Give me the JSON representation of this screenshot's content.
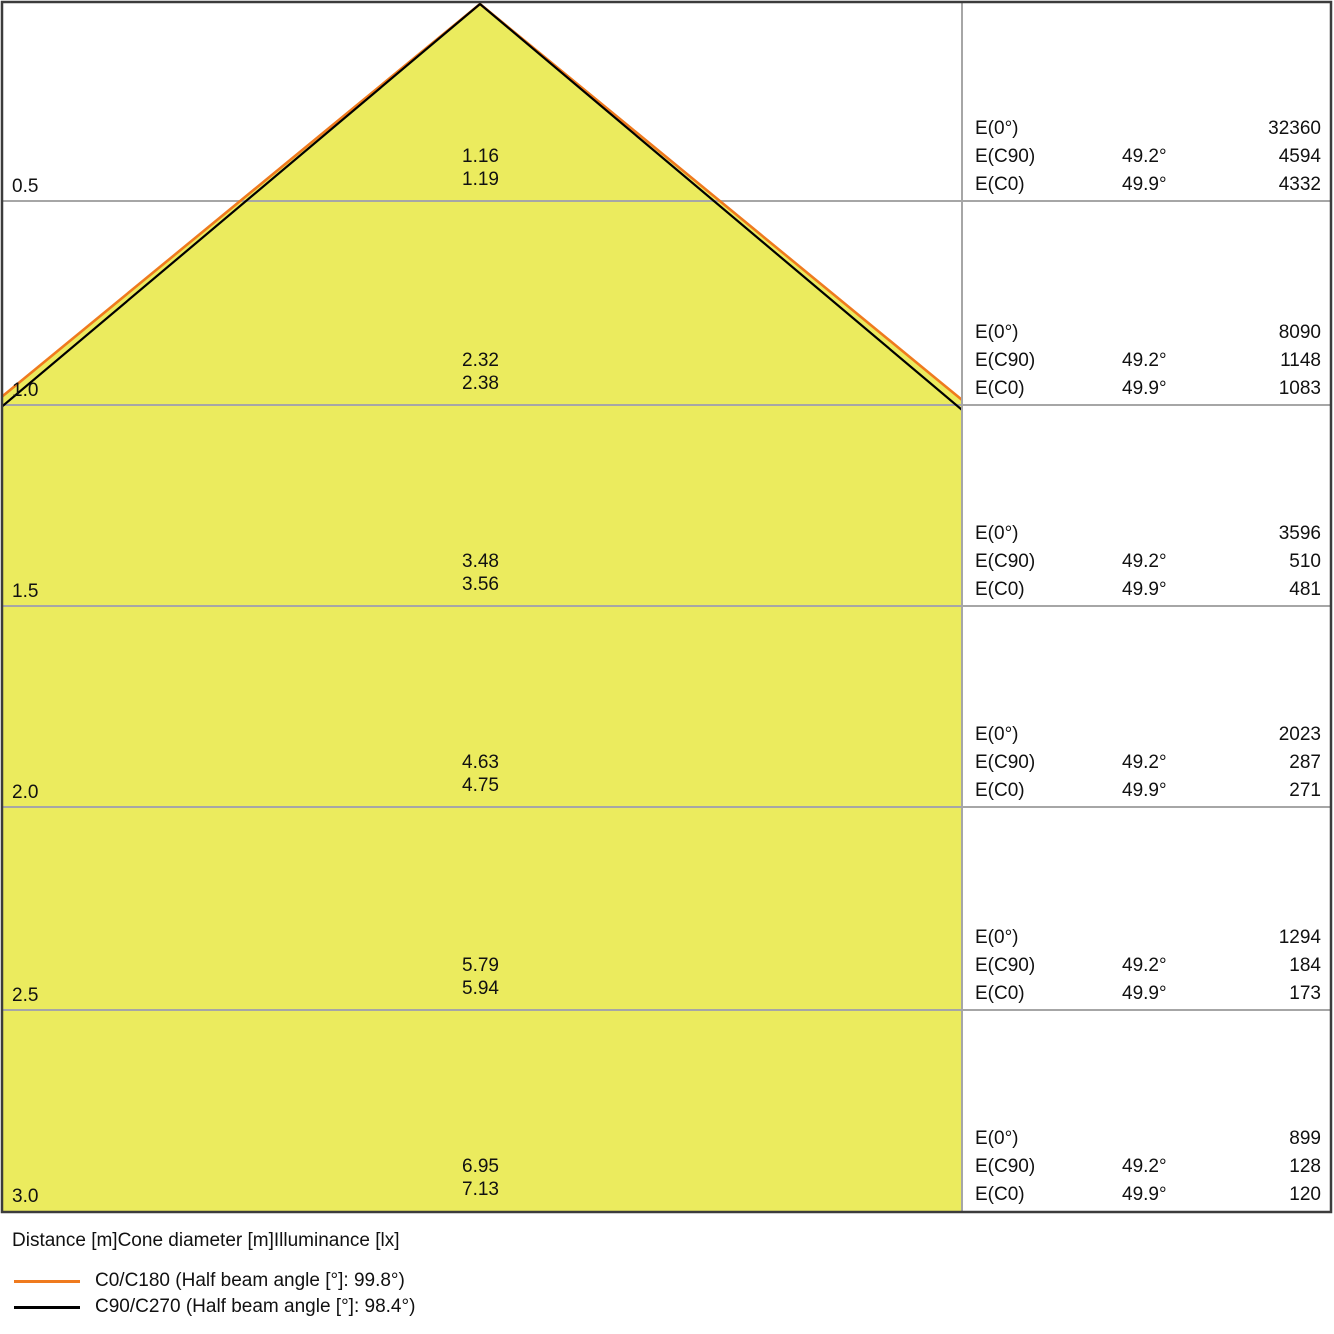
{
  "colors": {
    "cone_fill": "#ebeb5e",
    "c0_line": "#ef7a1e",
    "c90_line": "#000000",
    "grid_line": "#a6a6a6",
    "frame": "#3c3c3c"
  },
  "panel_labels": {
    "e0": "E(0°)",
    "ec90": "E(C90)",
    "ec0": "E(C0)"
  },
  "rows": [
    {
      "distance": "0.5",
      "cone_c90": "1.16",
      "cone_c0": "1.19",
      "e0": "32360",
      "ec90_angle": "49.2°",
      "ec90": "4594",
      "ec0_angle": "49.9°",
      "ec0": "4332"
    },
    {
      "distance": "1.0",
      "cone_c90": "2.32",
      "cone_c0": "2.38",
      "e0": "8090",
      "ec90_angle": "49.2°",
      "ec90": "1148",
      "ec0_angle": "49.9°",
      "ec0": "1083"
    },
    {
      "distance": "1.5",
      "cone_c90": "3.48",
      "cone_c0": "3.56",
      "e0": "3596",
      "ec90_angle": "49.2°",
      "ec90": "510",
      "ec0_angle": "49.9°",
      "ec0": "481"
    },
    {
      "distance": "2.0",
      "cone_c90": "4.63",
      "cone_c0": "4.75",
      "e0": "2023",
      "ec90_angle": "49.2°",
      "ec90": "287",
      "ec0_angle": "49.9°",
      "ec0": "271"
    },
    {
      "distance": "2.5",
      "cone_c90": "5.79",
      "cone_c0": "5.94",
      "e0": "1294",
      "ec90_angle": "49.2°",
      "ec90": "184",
      "ec0_angle": "49.9°",
      "ec0": "173"
    },
    {
      "distance": "3.0",
      "cone_c90": "6.95",
      "cone_c0": "7.13",
      "e0": "899",
      "ec90_angle": "49.2°",
      "ec90": "128",
      "ec0_angle": "49.9°",
      "ec0": "120"
    }
  ],
  "legend": {
    "title": "Distance [m]Cone diameter [m]Illuminance [lx]",
    "items": [
      {
        "label": "C0/C180 (Half beam angle [°]: 99.8°)",
        "color": "#ef7a1e"
      },
      {
        "label": "C90/C270 (Half beam angle [°]: 98.4°)",
        "color": "#000000"
      }
    ]
  },
  "chart_data": {
    "type": "area",
    "title": "",
    "xlabel": "Distance [m]Cone diameter [m]Illuminance [lx]",
    "distances_m": [
      0.5,
      1.0,
      1.5,
      2.0,
      2.5,
      3.0
    ],
    "series": [
      {
        "name": "C0/C180 (Half beam angle [°]: 99.8°)",
        "half_beam_angle_deg": 99.8,
        "half_angle_deg": 49.9,
        "cone_diameter_m": [
          1.19,
          2.38,
          3.56,
          4.75,
          5.94,
          7.13
        ],
        "illuminance_lx": [
          4332,
          1083,
          481,
          271,
          173,
          120
        ],
        "color": "#ef7a1e"
      },
      {
        "name": "C90/C270 (Half beam angle [°]: 98.4°)",
        "half_beam_angle_deg": 98.4,
        "half_angle_deg": 49.2,
        "cone_diameter_m": [
          1.16,
          2.32,
          3.48,
          4.63,
          5.79,
          6.95
        ],
        "illuminance_lx": [
          4594,
          1148,
          510,
          287,
          184,
          128
        ],
        "color": "#000000"
      },
      {
        "name": "E(0°)",
        "illuminance_lx": [
          32360,
          8090,
          3596,
          2023,
          1294,
          899
        ]
      }
    ],
    "legend_position": "bottom",
    "grid": true
  }
}
